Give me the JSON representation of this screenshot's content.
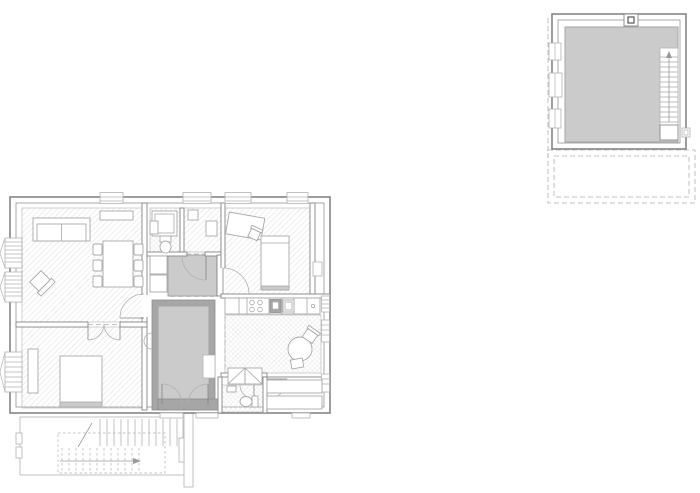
{
  "colors": {
    "background": "#ffffff",
    "wall": "#858585",
    "wall_light": "#b2b2b2",
    "gray_wall": "#a6a6a6",
    "gray_fill": "#cbcbcb",
    "hatch": "#dedede",
    "tile": "#e2e2e2",
    "furniture": "#a8a8a8",
    "dash": "#b0b0b0"
  },
  "drawing": {
    "type": "architectural floor plan, no text labels",
    "plans": [
      {
        "name": "ground-floor-plan",
        "position": "bottom-left",
        "rooms": [
          {
            "name": "living-room",
            "floor": "diagonal-hatch",
            "furniture": [
              "sofa",
              "armchair",
              "dining-table",
              "six-chairs",
              "sideboard"
            ]
          },
          {
            "name": "bedroom",
            "floor": "diagonal-hatch",
            "furniture": [
              "double-bed",
              "wardrobe-cabinet"
            ]
          },
          {
            "name": "bathroom",
            "floor": "tile",
            "furniture": [
              "shower",
              "toilet",
              "washbasin"
            ]
          },
          {
            "name": "storage-room",
            "floor": "diagonal-hatch",
            "furniture": [
              "cabinet",
              "washbasin"
            ]
          },
          {
            "name": "study-bedroom",
            "floor": "diagonal-hatch",
            "furniture": [
              "desk",
              "desk-chair",
              "single-bed"
            ]
          },
          {
            "name": "kitchen",
            "floor": "tile",
            "furniture": [
              "counter-with-hob-oven-sink",
              "round-table",
              "two-chairs",
              "closet-with-cross-bracing"
            ]
          },
          {
            "name": "wc",
            "floor": "tile",
            "furniture": [
              "toilet",
              "washbasin"
            ]
          },
          {
            "name": "utility-room",
            "floor": "plain",
            "furniture": [
              "shelving-unit",
              "shelving-unit"
            ]
          },
          {
            "name": "stair-hall",
            "floor": "solid-gray",
            "furniture": []
          },
          {
            "name": "vestibule",
            "floor": "solid-gray",
            "furniture": [
              "cupboards"
            ]
          }
        ],
        "exterior_features": [
          "bay-windows-left-wall",
          "garden-stair-terrace-below",
          "entrance-walkway",
          "entrance-steps"
        ]
      },
      {
        "name": "basement-plan",
        "position": "top-right",
        "rooms": [
          {
            "name": "cellar",
            "floor": "solid-gray"
          },
          {
            "name": "basement-staircase",
            "floor": "plain"
          }
        ],
        "features": [
          "three-light-wells-left-wall",
          "chimney-top-wall",
          "dashed-terrace-outline-below",
          "small-window-right-wall"
        ]
      }
    ]
  }
}
